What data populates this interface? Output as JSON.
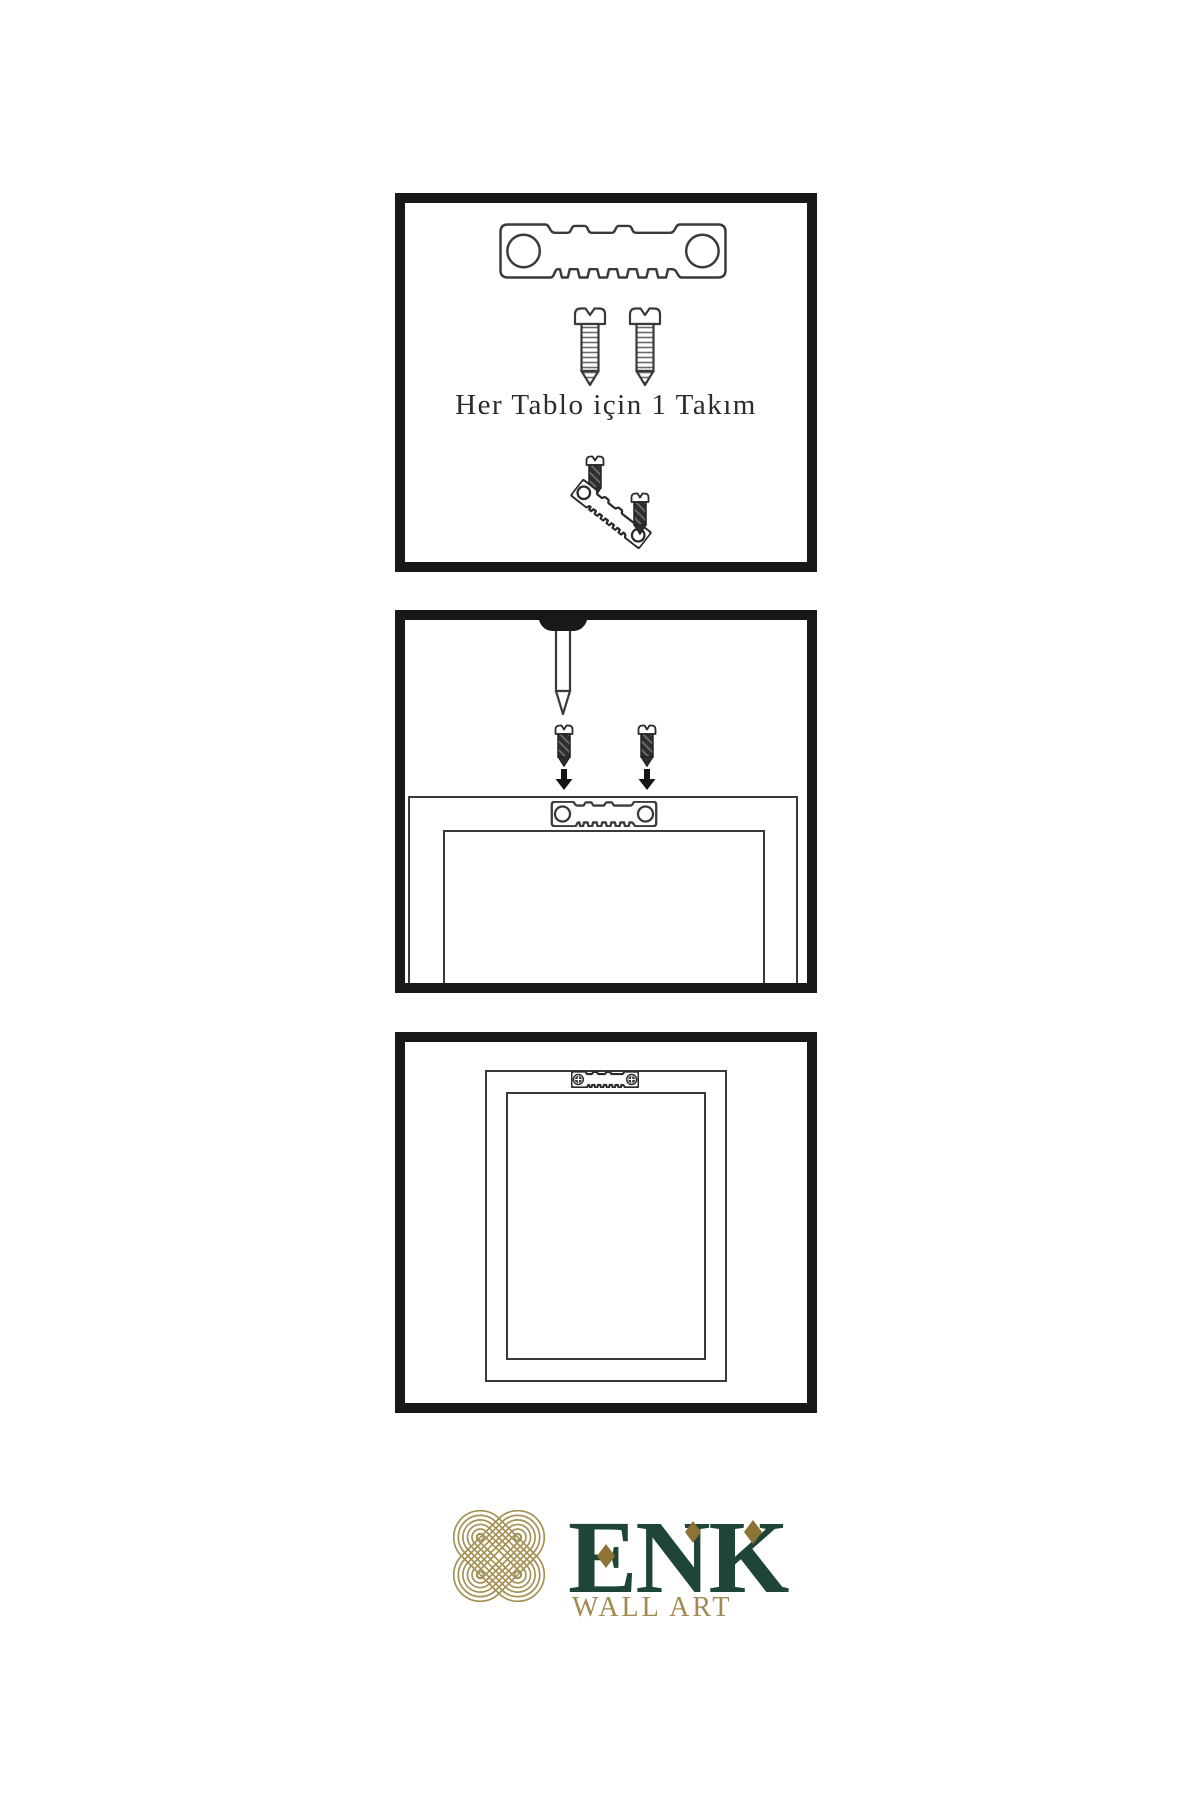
{
  "sheet": {
    "type": "wall-art-hanging-instructions",
    "background": "#ffffff",
    "panel_border_color": "#181818",
    "line_art_color": "#3a3a3a"
  },
  "steps": {
    "step1": {
      "name": "hardware-kit",
      "caption": "Her Tablo için 1 Takım",
      "parts": [
        "sawtooth-hanger",
        "screw",
        "screw",
        "mini-screw",
        "tilted-sawtooth-hanger",
        "mini-screw"
      ]
    },
    "step2": {
      "name": "wall-installation",
      "parts": [
        "wall-nail",
        "dark-screw",
        "dark-screw",
        "down-arrow",
        "down-arrow",
        "frame-back",
        "sawtooth-hanger"
      ]
    },
    "step3": {
      "name": "hung-frame",
      "parts": [
        "frame-back",
        "sawtooth-hanger-with-screws"
      ]
    }
  },
  "logo": {
    "brand": "ENK",
    "tagline": "WALL ART",
    "knot_icon": "interlaced-knot-icon",
    "colors": {
      "brand_green": "#1e4536",
      "tagline_gold": "#a1894f",
      "diamond_gold": "#8e7434",
      "knot_gold": "#a39050"
    }
  }
}
